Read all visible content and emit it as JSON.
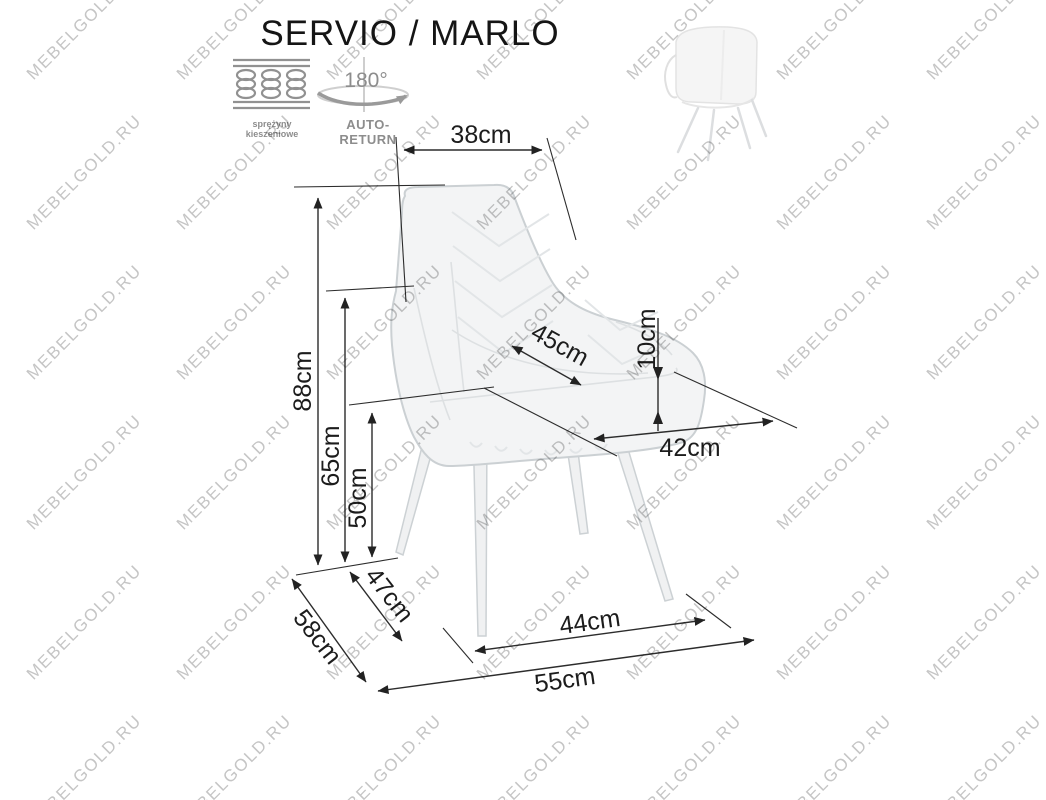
{
  "title": "SERVIO / MARLO",
  "watermark": {
    "text": "MEBELGOLD.RU",
    "color": "#c5c5c5"
  },
  "features": {
    "springs_icon": "pocket-springs-icon",
    "springs_label": "sprężyny kieszeniowe",
    "rotation_icon": "rotate-180-icon",
    "rotation_degrees": "180°",
    "auto_return_label": "AUTO-RETURN"
  },
  "dimensions": {
    "back_width": "38cm",
    "total_height": "88cm",
    "arm_height": "65cm",
    "seat_height": "50cm",
    "seat_width_diagonal": "45cm",
    "cushion_height": "10cm",
    "seat_depth": "42cm",
    "base_depth": "47cm",
    "total_depth": "58cm",
    "base_width": "44cm",
    "total_width": "55cm"
  },
  "colors": {
    "line": "#2c2c2c",
    "chair_outline": "#cbd0d3",
    "chair_fill": "#f3f4f5",
    "icon_gray": "#8d8d8d",
    "watermark_gray": "#c5c5c5"
  }
}
